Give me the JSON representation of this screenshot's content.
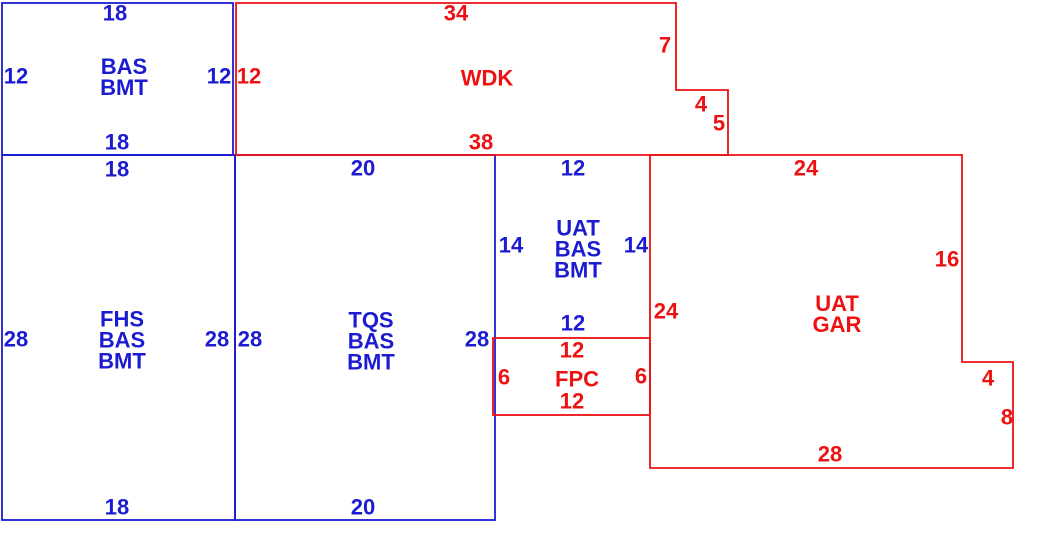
{
  "colors": {
    "blue": "#1b1bd1",
    "red": "#ed1111",
    "background": "#ffffff"
  },
  "regions": {
    "bas_bmt": {
      "name_lines": [
        "BAS",
        "BMT"
      ],
      "dim_top": "18",
      "dim_left": "12",
      "dim_right": "12",
      "dim_bottom": "18"
    },
    "wdk": {
      "name_lines": [
        "WDK"
      ],
      "dim_top": "34",
      "dim_left": "12",
      "dim_step_upper": "7",
      "dim_step_across": "4",
      "dim_step_lower": "5",
      "dim_bottom": "38"
    },
    "fhs_bas_bmt": {
      "name_lines": [
        "FHS",
        "BAS",
        "BMT"
      ],
      "dim_top": "18",
      "dim_left": "28",
      "dim_right": "28",
      "dim_bottom": "18"
    },
    "tqs_bas_bmt": {
      "name_lines": [
        "TQS",
        "BAS",
        "BMT"
      ],
      "dim_top": "20",
      "dim_left": "28",
      "dim_right": "28",
      "dim_bottom": "20"
    },
    "uat_bas_bmt": {
      "name_lines": [
        "UAT",
        "BAS",
        "BMT"
      ],
      "dim_top": "12",
      "dim_left": "14",
      "dim_right": "14",
      "dim_bottom": "12"
    },
    "uat_gar": {
      "name_lines": [
        "UAT",
        "GAR"
      ],
      "dim_top": "24",
      "dim_left": "24",
      "dim_right_upper": "16",
      "dim_notch_top": "4",
      "dim_notch_side": "8",
      "dim_bottom": "28"
    },
    "fpc": {
      "name_lines": [
        "FPC"
      ],
      "dim_top": "12",
      "dim_left": "6",
      "dim_right": "6",
      "dim_bottom": "12"
    }
  }
}
